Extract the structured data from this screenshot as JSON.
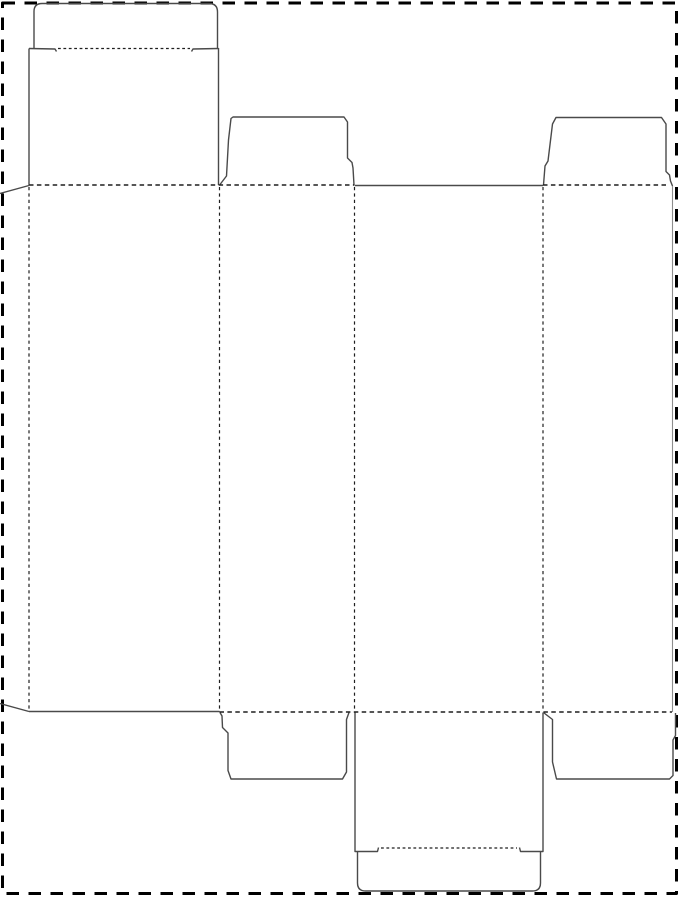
{
  "meta": {
    "aria_label": "box-dieline-template",
    "visible_text": ""
  },
  "canvas": {
    "width": 681,
    "height": 900,
    "background": "#ffffff"
  },
  "colors": {
    "border": "#000000",
    "cut": "#4a4a4a",
    "fold": "#1f1f1f",
    "light_edge": "#8d8d8d"
  },
  "layers": [
    {
      "name": "outer-cut-border",
      "stroke": "#000000",
      "stroke_width": 3,
      "dash": "12.5 9.5",
      "paths": [
        {
          "name": "border-rect",
          "d": "M 2.5,3 L 676.5,3 L 676.5,893.5 L 2.5,893.5 Z"
        }
      ]
    },
    {
      "name": "cut-lines",
      "stroke": "#4a4a4a",
      "stroke_width": 1.4,
      "dash": "",
      "paths": [
        {
          "name": "glue-flap-top-slant",
          "d": "M 0,193.5 L 29,185.5"
        },
        {
          "name": "glue-flap-bottom-slant",
          "d": "M 0,703.5 L 29,711.5"
        },
        {
          "name": "top-closure-panel-left-edge",
          "d": "M 29,185 L 29,48.5"
        },
        {
          "name": "top-closure-panel-right-edge",
          "d": "M 218.5,185 L 218.5,48"
        },
        {
          "name": "top-tuck-flap",
          "d": "M 34,48.5 L 34,11.5 Q 34,3.5 42,3.5 L 209,3.5 Q 217.5,3.5 217.5,12 L 217.5,48"
        },
        {
          "name": "top-tuck-slit-left",
          "d": "M 29,48.5 L 55,49 L 56.5,51.5"
        },
        {
          "name": "top-tuck-slit-right",
          "d": "M 218.5,48.5 L 193,49 L 191.5,51.5"
        },
        {
          "name": "top-dust-flap-side1",
          "d": "M 220,184.5 L 226.5,176 L 228.5,140 L 231,118.5 L 233,117 L 344,117 L 347.5,122 L 347.5,158 L 352,162.5 L 353,168 L 354,185"
        },
        {
          "name": "front-panel-top-edge",
          "d": "M 354.5,185.5 L 543,185.5"
        },
        {
          "name": "top-dust-flap-side2",
          "d": "M 543.5,185 L 545,166 L 548,161 L 552.5,124 L 556,117.5 L 661.5,117.5 L 666,124 L 666,171.5 L 669.5,175 L 670.5,181 L 672.5,186"
        },
        {
          "name": "back-panel-bottom-edge",
          "d": "M 29,711.5 L 219.5,711.5"
        },
        {
          "name": "bottom-dust-flap-side1",
          "d": "M 220,712.5 L 222,716 L 222.5,727.5 L 228,733 L 228,770.5 L 231,779 L 342.5,779 L 346.5,772 L 346.5,719.5 L 349,712.5"
        },
        {
          "name": "bottom-closure-panel-left-edge",
          "d": "M 355,712.5 L 355,851.5 L 377.5,851.5 L 378.5,847.5"
        },
        {
          "name": "bottom-closure-panel-right-edge",
          "d": "M 543,712.5 L 543,851.5 L 520.5,851.5 L 519.5,847.5"
        },
        {
          "name": "bottom-tuck-flap",
          "d": "M 357.5,851.5 L 357.5,883 Q 357.5,891 365.5,891 L 532.5,891 Q 540.5,891 540.5,883 L 540.5,851.5"
        },
        {
          "name": "bottom-dust-flap-side2",
          "d": "M 543.5,712.5 L 546,714.5 L 552.5,719.5 L 552.5,762 L 556.5,779 L 669.5,779 L 673,775.5 L 673,740 L 675.5,735.5 L 675.5,713"
        }
      ]
    },
    {
      "name": "light-cut-edge",
      "stroke": "#8d8d8d",
      "stroke_width": 1.1,
      "dash": "",
      "paths": [
        {
          "name": "right-panel-outer-edge",
          "d": "M 672.5,186 L 672.5,712"
        }
      ]
    },
    {
      "name": "horizontal-fold-lines",
      "stroke": "#1f1f1f",
      "stroke_width": 1.5,
      "dash": "4.5 3.4",
      "paths": [
        {
          "name": "top-fold-left-segment",
          "d": "M 29,185 L 354,185"
        },
        {
          "name": "top-fold-right-segment",
          "d": "M 543,185 L 668,185"
        },
        {
          "name": "bottom-fold",
          "d": "M 219.5,712 L 672,712"
        }
      ]
    },
    {
      "name": "vertical-fold-lines",
      "stroke": "#1f1f1f",
      "stroke_width": 1.2,
      "dash": "3.2 3.2",
      "paths": [
        {
          "name": "glue-flap-fold",
          "d": "M 29,187 L 29,710"
        },
        {
          "name": "panel-fold-1",
          "d": "M 219.5,187 L 219.5,710"
        },
        {
          "name": "panel-fold-2",
          "d": "M 354.5,187 L 354.5,710"
        },
        {
          "name": "panel-fold-3",
          "d": "M 543,187 L 543,710"
        }
      ]
    },
    {
      "name": "tuck-fold-lines",
      "stroke": "#1f1f1f",
      "stroke_width": 1.2,
      "dash": "2.8 2.6",
      "paths": [
        {
          "name": "top-tuck-fold",
          "d": "M 58,48.5 L 190,48.5"
        },
        {
          "name": "bottom-tuck-fold",
          "d": "M 381,848 L 517,848"
        }
      ]
    }
  ]
}
